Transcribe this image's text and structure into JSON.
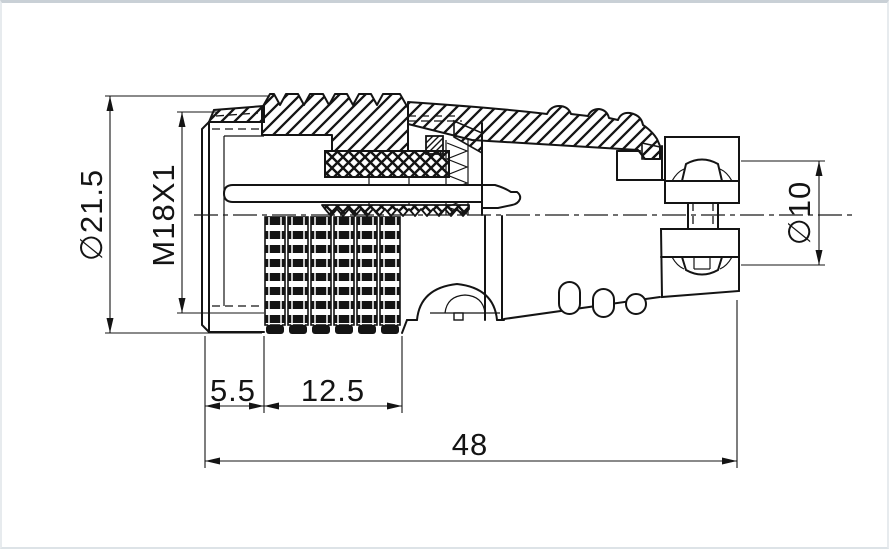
{
  "drawing": {
    "description": "Cross-section engineering drawing of a circular connector plug with coupling nut, insulator, contact pin, knurled grip and cable clamp",
    "labels": {
      "outer_diameter": "∅21.5",
      "thread_spec": "M18X1",
      "cable_diameter": "∅10",
      "front_length": "5.5",
      "knurl_length": "12.5",
      "overall_length": "48"
    },
    "colors": {
      "line": "#141414",
      "background": "#ffffff",
      "frame_top": "#c9d0d6",
      "frame_side": "#e7ebee"
    }
  }
}
